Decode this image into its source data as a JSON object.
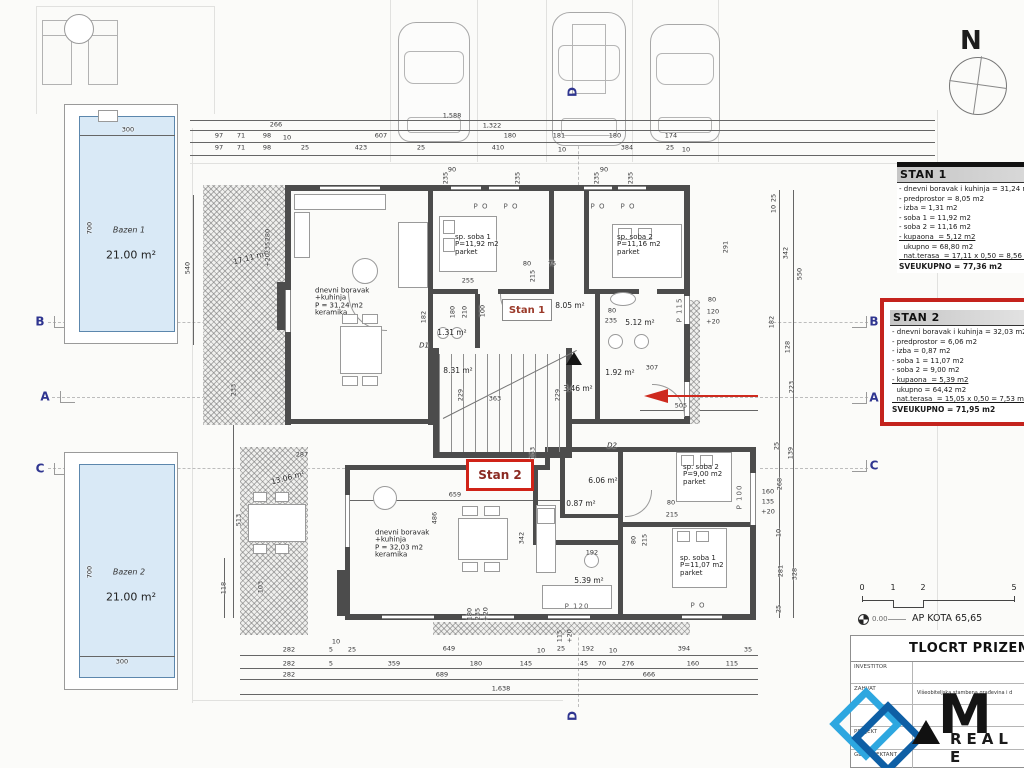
{
  "compass": {
    "label": "N"
  },
  "pools": {
    "bazen1": {
      "name": "Bazen 1",
      "area": "21.00 m²"
    },
    "bazen2": {
      "name": "Bazen 2",
      "area": "21.00 m²"
    }
  },
  "stan_labels": {
    "stan1": "Stan 1",
    "stan2": "Stan 2"
  },
  "panels": {
    "stan1": {
      "title": "STAN 1",
      "lines": [
        {
          "t": "- dnevni boravak i kuhinja = 31,24 m2"
        },
        {
          "t": "- predprostor = 8,05 m2"
        },
        {
          "t": "- izba = 1,31 m2"
        },
        {
          "t": "- soba 1 = 11,92 m2"
        },
        {
          "t": "- soba 2 = 11,16 m2"
        },
        {
          "t": "- kupaona  = 5,12 m2",
          "u": 1
        },
        {
          "t": "  ukupno = 68,80 m2"
        },
        {
          "t": "  nat.terasa  = 17,11 x 0,50 = 8,56 m2",
          "u": 1
        },
        {
          "t": "SVEUKUPNO = 77,36 m2",
          "b": 1
        }
      ]
    },
    "stan2": {
      "title": "STAN 2",
      "lines": [
        {
          "t": "- dnevni boravak i kuhinja = 32,03 m2"
        },
        {
          "t": "- predprostor = 6,06 m2"
        },
        {
          "t": "- izba = 0,87 m2"
        },
        {
          "t": "- soba 1 = 11,07 m2"
        },
        {
          "t": "- soba 2 = 9,00 m2"
        },
        {
          "t": "- kupaona  = 5,39 m2",
          "u": 1
        },
        {
          "t": "  ukupno = 64,42 m2"
        },
        {
          "t": "  nat.terasa  = 15,05 x 0,50 = 7,53 m2",
          "u": 1
        },
        {
          "t": "SVEUKUPNO = 71,95 m2",
          "b": 1
        }
      ]
    }
  },
  "scale": {
    "ticks": [
      "0",
      "1",
      "2",
      "5"
    ],
    "level": "0.00",
    "kota": "AP KOTA 65,65"
  },
  "title_block": {
    "title": "TLOCRT PRIZEMLJA",
    "rows": [
      {
        "label": "INVESTITOR",
        "value": ""
      },
      {
        "label": "ZAHVAT",
        "value": "Višeobiteljska stambena građevina i d"
      },
      {
        "label": "",
        "value": ""
      },
      {
        "label": "PROJEKT",
        "value": ""
      },
      {
        "label": "GL.PROJEKTANT",
        "value": ""
      }
    ],
    "logo_main": "M",
    "logo_sub": "REAL E"
  },
  "annotations": [
    {
      "t": "266",
      "x": 276,
      "y": 125
    },
    {
      "t": "1,588",
      "x": 452,
      "y": 116
    },
    {
      "t": "1,322",
      "x": 492,
      "y": 126
    },
    {
      "t": "97",
      "x": 219,
      "y": 136
    },
    {
      "t": "71",
      "x": 241,
      "y": 136
    },
    {
      "t": "98",
      "x": 267,
      "y": 136
    },
    {
      "t": "10",
      "x": 287,
      "y": 138
    },
    {
      "t": "607",
      "x": 381,
      "y": 136
    },
    {
      "t": "180",
      "x": 510,
      "y": 136
    },
    {
      "t": "181",
      "x": 559,
      "y": 136
    },
    {
      "t": "180",
      "x": 615,
      "y": 136
    },
    {
      "t": "174",
      "x": 671,
      "y": 136
    },
    {
      "t": "97",
      "x": 219,
      "y": 148
    },
    {
      "t": "71",
      "x": 241,
      "y": 148
    },
    {
      "t": "98",
      "x": 267,
      "y": 148
    },
    {
      "t": "25",
      "x": 305,
      "y": 148
    },
    {
      "t": "423",
      "x": 361,
      "y": 148
    },
    {
      "t": "25",
      "x": 421,
      "y": 148
    },
    {
      "t": "410",
      "x": 498,
      "y": 148
    },
    {
      "t": "10",
      "x": 562,
      "y": 150
    },
    {
      "t": "384",
      "x": 627,
      "y": 148
    },
    {
      "t": "25",
      "x": 670,
      "y": 148
    },
    {
      "t": "10",
      "x": 686,
      "y": 150
    },
    {
      "t": "300",
      "x": 128,
      "y": 130
    },
    {
      "t": "700",
      "x": 90,
      "y": 228,
      "r": -90
    },
    {
      "t": "540",
      "x": 188,
      "y": 268,
      "r": -90
    },
    {
      "t": "700",
      "x": 90,
      "y": 572,
      "r": -90
    },
    {
      "t": "300",
      "x": 122,
      "y": 662
    },
    {
      "t": "233",
      "x": 234,
      "y": 390,
      "r": -90
    },
    {
      "t": "513",
      "x": 239,
      "y": 520,
      "r": -90
    },
    {
      "t": "118",
      "x": 224,
      "y": 588,
      "r": -90
    },
    {
      "t": "103",
      "x": 261,
      "y": 587,
      "r": -90
    },
    {
      "t": "287",
      "x": 302,
      "y": 455
    },
    {
      "t": "280",
      "x": 268,
      "y": 235,
      "r": -90
    },
    {
      "t": "235",
      "x": 268,
      "y": 248,
      "r": -90
    },
    {
      "t": "+20",
      "x": 268,
      "y": 260,
      "r": -90
    },
    {
      "t": "17.11 m²",
      "x": 250,
      "y": 258,
      "r": -15,
      "c": "a"
    },
    {
      "t": "90",
      "x": 452,
      "y": 170
    },
    {
      "t": "235",
      "x": 446,
      "y": 178,
      "r": -90
    },
    {
      "t": "235",
      "x": 518,
      "y": 178,
      "r": -90
    },
    {
      "t": "90",
      "x": 604,
      "y": 170
    },
    {
      "t": "235",
      "x": 597,
      "y": 178,
      "r": -90
    },
    {
      "t": "235",
      "x": 631,
      "y": 178,
      "r": -90
    },
    {
      "t": "P O",
      "x": 481,
      "y": 207,
      "c": "w"
    },
    {
      "t": "P O",
      "x": 511,
      "y": 207,
      "c": "w"
    },
    {
      "t": "P O",
      "x": 598,
      "y": 207,
      "c": "w"
    },
    {
      "t": "P O",
      "x": 628,
      "y": 207,
      "c": "w"
    },
    {
      "t": "P O",
      "x": 698,
      "y": 606,
      "c": "w"
    },
    {
      "t": "P 115",
      "x": 680,
      "y": 310,
      "r": -90,
      "c": "w"
    },
    {
      "t": "P 100",
      "x": 740,
      "y": 497,
      "r": -90,
      "c": "w"
    },
    {
      "t": "P 120",
      "x": 577,
      "y": 607,
      "c": "w"
    },
    {
      "t": "dnevni boravak\n+kuhinja\nP = 31,24 m2\nkeramika",
      "x": 315,
      "y": 302,
      "c": "r"
    },
    {
      "t": "sp. soba 1\nP=11,92 m2\nparket",
      "x": 455,
      "y": 245,
      "c": "r"
    },
    {
      "t": "sp. soba 2\nP=11,16 m2\nparket",
      "x": 617,
      "y": 245,
      "c": "r"
    },
    {
      "t": "dnevni boravak\n+kuhinja\nP = 32,03 m2\nkeramika",
      "x": 375,
      "y": 544,
      "c": "r"
    },
    {
      "t": "sp. soba 2\nP=9,00 m2\nparket",
      "x": 683,
      "y": 475,
      "c": "r"
    },
    {
      "t": "sp. soba 1\nP=11,07 m2\nparket",
      "x": 680,
      "y": 566,
      "c": "r"
    },
    {
      "t": "8.05 m²",
      "x": 570,
      "y": 306,
      "c": "a"
    },
    {
      "t": "5.12 m²",
      "x": 640,
      "y": 323,
      "c": "a"
    },
    {
      "t": "1.31 m²",
      "x": 452,
      "y": 333,
      "c": "a"
    },
    {
      "t": "8.31 m²",
      "x": 458,
      "y": 371,
      "c": "a"
    },
    {
      "t": "3.46 m²",
      "x": 578,
      "y": 389,
      "c": "a"
    },
    {
      "t": "1.92 m²",
      "x": 620,
      "y": 373,
      "c": "a"
    },
    {
      "t": "6.06 m²",
      "x": 603,
      "y": 481,
      "c": "a"
    },
    {
      "t": "0.87 m²",
      "x": 581,
      "y": 504,
      "c": "a"
    },
    {
      "t": "5.39 m²",
      "x": 589,
      "y": 581,
      "c": "a"
    },
    {
      "t": "13.06 m²",
      "x": 288,
      "y": 478,
      "r": -15,
      "c": "a"
    },
    {
      "t": "255",
      "x": 468,
      "y": 281
    },
    {
      "t": "80",
      "x": 527,
      "y": 264
    },
    {
      "t": "215",
      "x": 533,
      "y": 276,
      "r": -90
    },
    {
      "t": "75",
      "x": 552,
      "y": 264
    },
    {
      "t": "291",
      "x": 726,
      "y": 247,
      "r": -90
    },
    {
      "t": "182",
      "x": 424,
      "y": 317,
      "r": -90
    },
    {
      "t": "180",
      "x": 453,
      "y": 312,
      "r": -90
    },
    {
      "t": "210",
      "x": 465,
      "y": 312,
      "r": -90
    },
    {
      "t": "100",
      "x": 483,
      "y": 311,
      "r": -90
    },
    {
      "t": "80",
      "x": 612,
      "y": 311
    },
    {
      "t": "235",
      "x": 611,
      "y": 321
    },
    {
      "t": "229",
      "x": 461,
      "y": 395,
      "r": -90
    },
    {
      "t": "363",
      "x": 495,
      "y": 399
    },
    {
      "t": "229",
      "x": 558,
      "y": 395,
      "r": -90
    },
    {
      "t": "307",
      "x": 652,
      "y": 368
    },
    {
      "t": "505",
      "x": 681,
      "y": 406
    },
    {
      "t": "25",
      "x": 774,
      "y": 198,
      "r": -90
    },
    {
      "t": "10",
      "x": 774,
      "y": 209,
      "r": -90
    },
    {
      "t": "342",
      "x": 786,
      "y": 253,
      "r": -90
    },
    {
      "t": "550",
      "x": 800,
      "y": 274,
      "r": -90
    },
    {
      "t": "182",
      "x": 772,
      "y": 322,
      "r": -90
    },
    {
      "t": "128",
      "x": 788,
      "y": 347,
      "r": -90
    },
    {
      "t": "223",
      "x": 792,
      "y": 387,
      "r": -90
    },
    {
      "t": "80",
      "x": 712,
      "y": 300
    },
    {
      "t": "120",
      "x": 713,
      "y": 312
    },
    {
      "t": "+20",
      "x": 713,
      "y": 322
    },
    {
      "t": "25",
      "x": 777,
      "y": 446,
      "r": -90
    },
    {
      "t": "139",
      "x": 791,
      "y": 453,
      "r": -90
    },
    {
      "t": "268",
      "x": 780,
      "y": 484,
      "r": -90
    },
    {
      "t": "160",
      "x": 768,
      "y": 492
    },
    {
      "t": "135",
      "x": 768,
      "y": 502
    },
    {
      "t": "+20",
      "x": 768,
      "y": 512
    },
    {
      "t": "10",
      "x": 779,
      "y": 533,
      "r": -90
    },
    {
      "t": "281",
      "x": 781,
      "y": 571,
      "r": -90
    },
    {
      "t": "328",
      "x": 795,
      "y": 574,
      "r": -90
    },
    {
      "t": "25",
      "x": 779,
      "y": 609,
      "r": -90
    },
    {
      "t": "659",
      "x": 455,
      "y": 495
    },
    {
      "t": "486",
      "x": 435,
      "y": 518,
      "r": -90
    },
    {
      "t": "342",
      "x": 522,
      "y": 538,
      "r": -90
    },
    {
      "t": "192",
      "x": 592,
      "y": 553
    },
    {
      "t": "133",
      "x": 533,
      "y": 453,
      "r": -90
    },
    {
      "t": "80",
      "x": 671,
      "y": 503
    },
    {
      "t": "215",
      "x": 672,
      "y": 515
    },
    {
      "t": "80",
      "x": 634,
      "y": 540,
      "r": -90
    },
    {
      "t": "215",
      "x": 645,
      "y": 540,
      "r": -90
    },
    {
      "t": "180",
      "x": 470,
      "y": 614,
      "r": -90
    },
    {
      "t": "235",
      "x": 478,
      "y": 614,
      "r": -90
    },
    {
      "t": "+20",
      "x": 486,
      "y": 614,
      "r": -90
    },
    {
      "t": "115",
      "x": 560,
      "y": 636,
      "r": -90
    },
    {
      "t": "+20",
      "x": 570,
      "y": 636,
      "r": -90
    },
    {
      "t": "10",
      "x": 336,
      "y": 642
    },
    {
      "t": "282",
      "x": 289,
      "y": 650
    },
    {
      "t": "5",
      "x": 331,
      "y": 650
    },
    {
      "t": "25",
      "x": 352,
      "y": 650
    },
    {
      "t": "649",
      "x": 449,
      "y": 649
    },
    {
      "t": "10",
      "x": 541,
      "y": 651
    },
    {
      "t": "25",
      "x": 561,
      "y": 649
    },
    {
      "t": "192",
      "x": 588,
      "y": 649
    },
    {
      "t": "10",
      "x": 613,
      "y": 651
    },
    {
      "t": "394",
      "x": 684,
      "y": 649
    },
    {
      "t": "35",
      "x": 748,
      "y": 650
    },
    {
      "t": "282",
      "x": 289,
      "y": 664
    },
    {
      "t": "5",
      "x": 331,
      "y": 664
    },
    {
      "t": "359",
      "x": 394,
      "y": 664
    },
    {
      "t": "180",
      "x": 476,
      "y": 664
    },
    {
      "t": "145",
      "x": 526,
      "y": 664
    },
    {
      "t": "45",
      "x": 584,
      "y": 664
    },
    {
      "t": "70",
      "x": 602,
      "y": 664
    },
    {
      "t": "276",
      "x": 628,
      "y": 664
    },
    {
      "t": "160",
      "x": 693,
      "y": 664
    },
    {
      "t": "115",
      "x": 732,
      "y": 664
    },
    {
      "t": "282",
      "x": 289,
      "y": 675
    },
    {
      "t": "689",
      "x": 442,
      "y": 675
    },
    {
      "t": "666",
      "x": 649,
      "y": 675
    },
    {
      "t": "1,638",
      "x": 501,
      "y": 689
    },
    {
      "t": "B",
      "x": 40,
      "y": 322,
      "c": "g"
    },
    {
      "t": "A",
      "x": 45,
      "y": 397,
      "c": "g"
    },
    {
      "t": "C",
      "x": 40,
      "y": 469,
      "c": "g"
    },
    {
      "t": "B",
      "x": 874,
      "y": 322,
      "c": "g"
    },
    {
      "t": "A",
      "x": 874,
      "y": 398,
      "c": "g"
    },
    {
      "t": "C",
      "x": 874,
      "y": 466,
      "c": "g"
    },
    {
      "t": "D",
      "x": 573,
      "y": 92,
      "r": -90,
      "c": "g"
    },
    {
      "t": "D",
      "x": 573,
      "y": 716,
      "r": -90,
      "c": "g"
    },
    {
      "t": "D1",
      "x": 424,
      "y": 346,
      "c": "dr"
    },
    {
      "t": "D2",
      "x": 612,
      "y": 446,
      "c": "dr"
    }
  ]
}
